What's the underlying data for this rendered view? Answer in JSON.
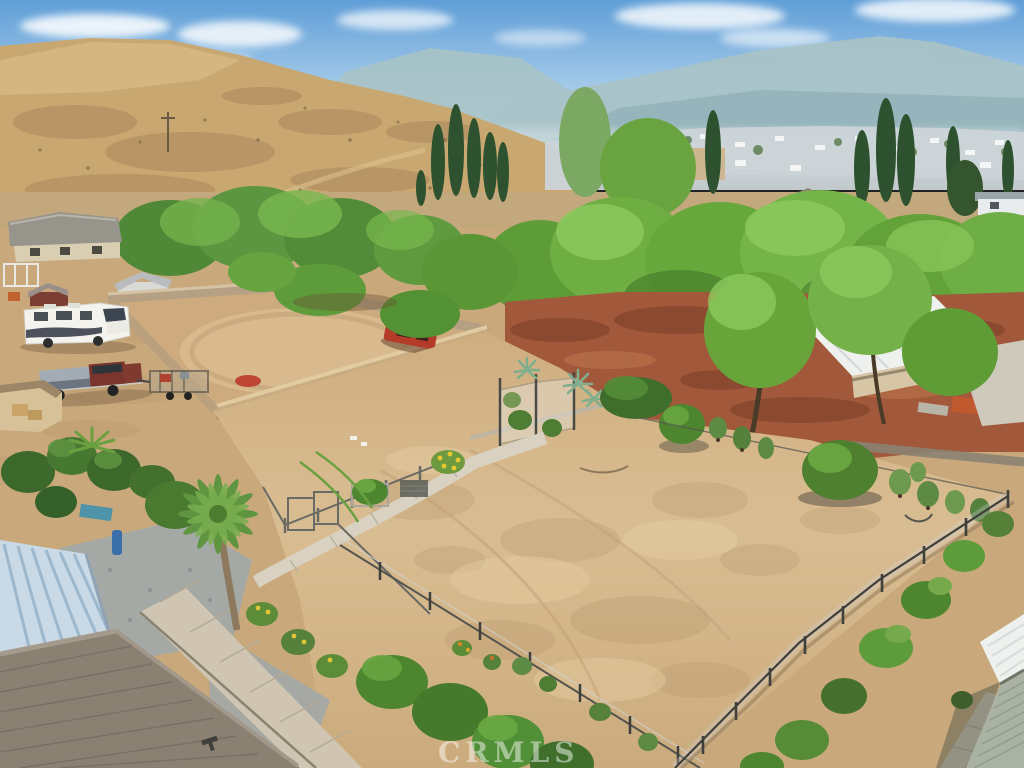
{
  "image": {
    "title": "Aerial drone view of a fenced dirt lot property with block-wall arena, RV, sheds, surrounding homes, tree line, golden hills and hazy mountains",
    "watermark_text": "CRMLS"
  },
  "palette": {
    "sky_top": "#5f9ed7",
    "sky_low": "#ddecf7",
    "mountain_far": "#a9c3c7",
    "mountain_mid": "#92b2b8",
    "hill_tan": "#c9a770",
    "field": "#c2a87c",
    "suburb": "#ccd4d8",
    "tree_dark": "#3c662c",
    "tree_mid": "#55913a",
    "tree_light": "#79b84f",
    "cypress": "#2e5230",
    "red_soil": "#a2583a",
    "dirt": "#c9a97c",
    "dirt_light": "#dcc195",
    "arena_dirt": "#cdab7e",
    "wall_block": "#c8ab81",
    "concrete": "#d7d0c1",
    "gravel": "#a0a8aa",
    "rv_white": "#f4f3ee",
    "truck_maroon": "#7b352c",
    "car_red": "#b43b2a",
    "barn_roof": "#eef1ee",
    "blue_roof": "#c9d9e6",
    "shingle_roof": "#8a8173",
    "siding_sage": "#a9b2a3",
    "watermark": "#ffffff"
  }
}
